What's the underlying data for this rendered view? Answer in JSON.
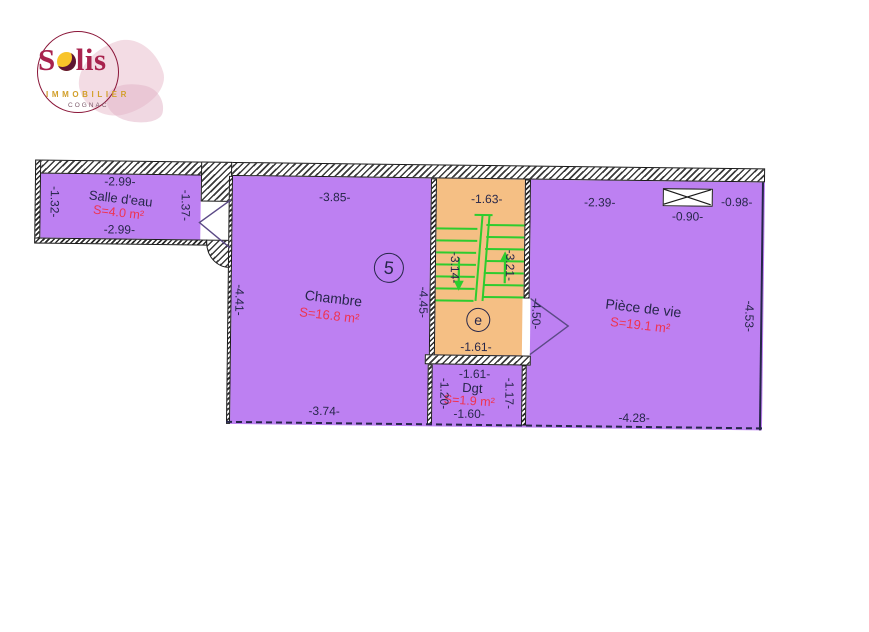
{
  "logo": {
    "brand_s": "S",
    "brand_rest": "lis",
    "subtitle": "IMMOBILIER",
    "city": "COGNAC"
  },
  "plan": {
    "floor_marker": "5",
    "stair_marker": "e",
    "rooms": {
      "salle_deau": {
        "name": "Salle d'eau",
        "area": "S=4.0 m²",
        "dim_top": "-2.99-",
        "dim_bottom": "-2.99-",
        "dim_left": "-1.32-",
        "dim_right": "-1.37-"
      },
      "chambre": {
        "name": "Chambre",
        "area": "S=16.8 m²",
        "dim_top": "-3.85-",
        "dim_bottom": "-3.74-",
        "dim_left": "-4.41-",
        "dim_right": "-4.45-"
      },
      "stairs": {
        "dim_top": "-1.63-",
        "dim_bottom": "-1.61-",
        "dim_left": "-3.14-",
        "dim_right": "-3.21-"
      },
      "dgt": {
        "name": "Dgt",
        "area": "S=1.9 m²",
        "dim_top": "-1.61-",
        "dim_bottom": "-1.60-",
        "dim_left": "-1.20-",
        "dim_right": "-1.17-"
      },
      "piece_de_vie": {
        "name": "Pièce de vie",
        "area": "S=19.1 m²",
        "dim_top_left": "-2.39-",
        "dim_top_right": "-0.98-",
        "dim_window": "-0.90-",
        "dim_left": "-4.50-",
        "dim_right": "-4.53-",
        "dim_bottom": "-4.28-"
      }
    },
    "colors": {
      "room_fill": "#bd80f2",
      "stair_fill": "#f5bf84",
      "stair_lines": "#2ecc2e",
      "dim_text": "#26264a",
      "area_text": "#ef3350",
      "brand_crimson": "#a8234e",
      "brand_gold": "#d2a02b"
    }
  }
}
